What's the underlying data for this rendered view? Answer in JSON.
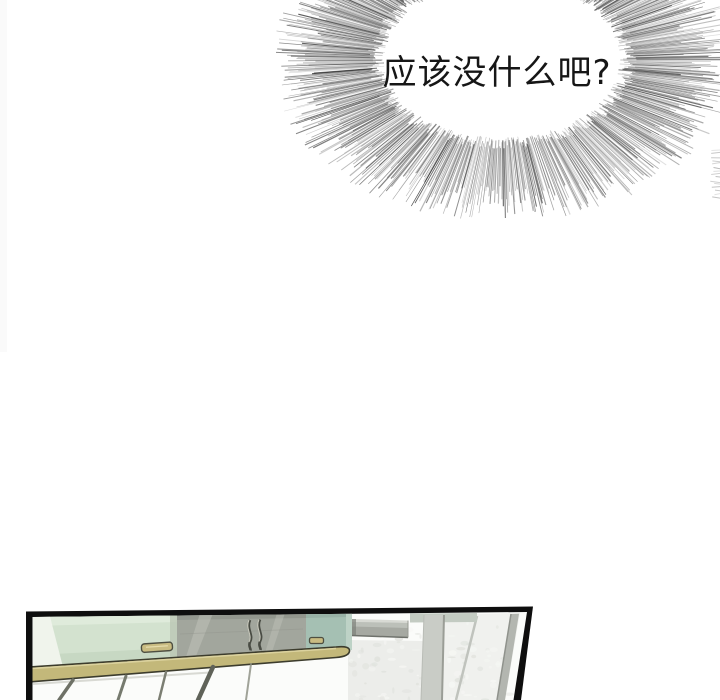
{
  "page": {
    "width": 720,
    "height": 700,
    "background": "#ffffff"
  },
  "speech_bubble": {
    "text": "应该没什么吧?",
    "style": "radial-burst-ellipse",
    "text_color": "#161616",
    "line_color": "#3a3a3a"
  },
  "panel": {
    "type": "kitchen-scene-illustration",
    "border_color": "#0e0e0e"
  },
  "palette": {
    "door_green": "#d3e2cf",
    "door_green_light": "#e6efe0",
    "door_green_shade": "#b9cdb4",
    "door_teal": "#a5c0b3",
    "glass_gray": "#a2a69d",
    "counter_khaki": "#c3b87a",
    "counter_highlight": "#dfd6a4",
    "handle_tan": "#c9bc82",
    "column_gray": "#c9ccc6",
    "wall_speckle": "#ecedea",
    "hood_gray": "#a6a9a2",
    "frame_black": "#0e0e0e"
  }
}
